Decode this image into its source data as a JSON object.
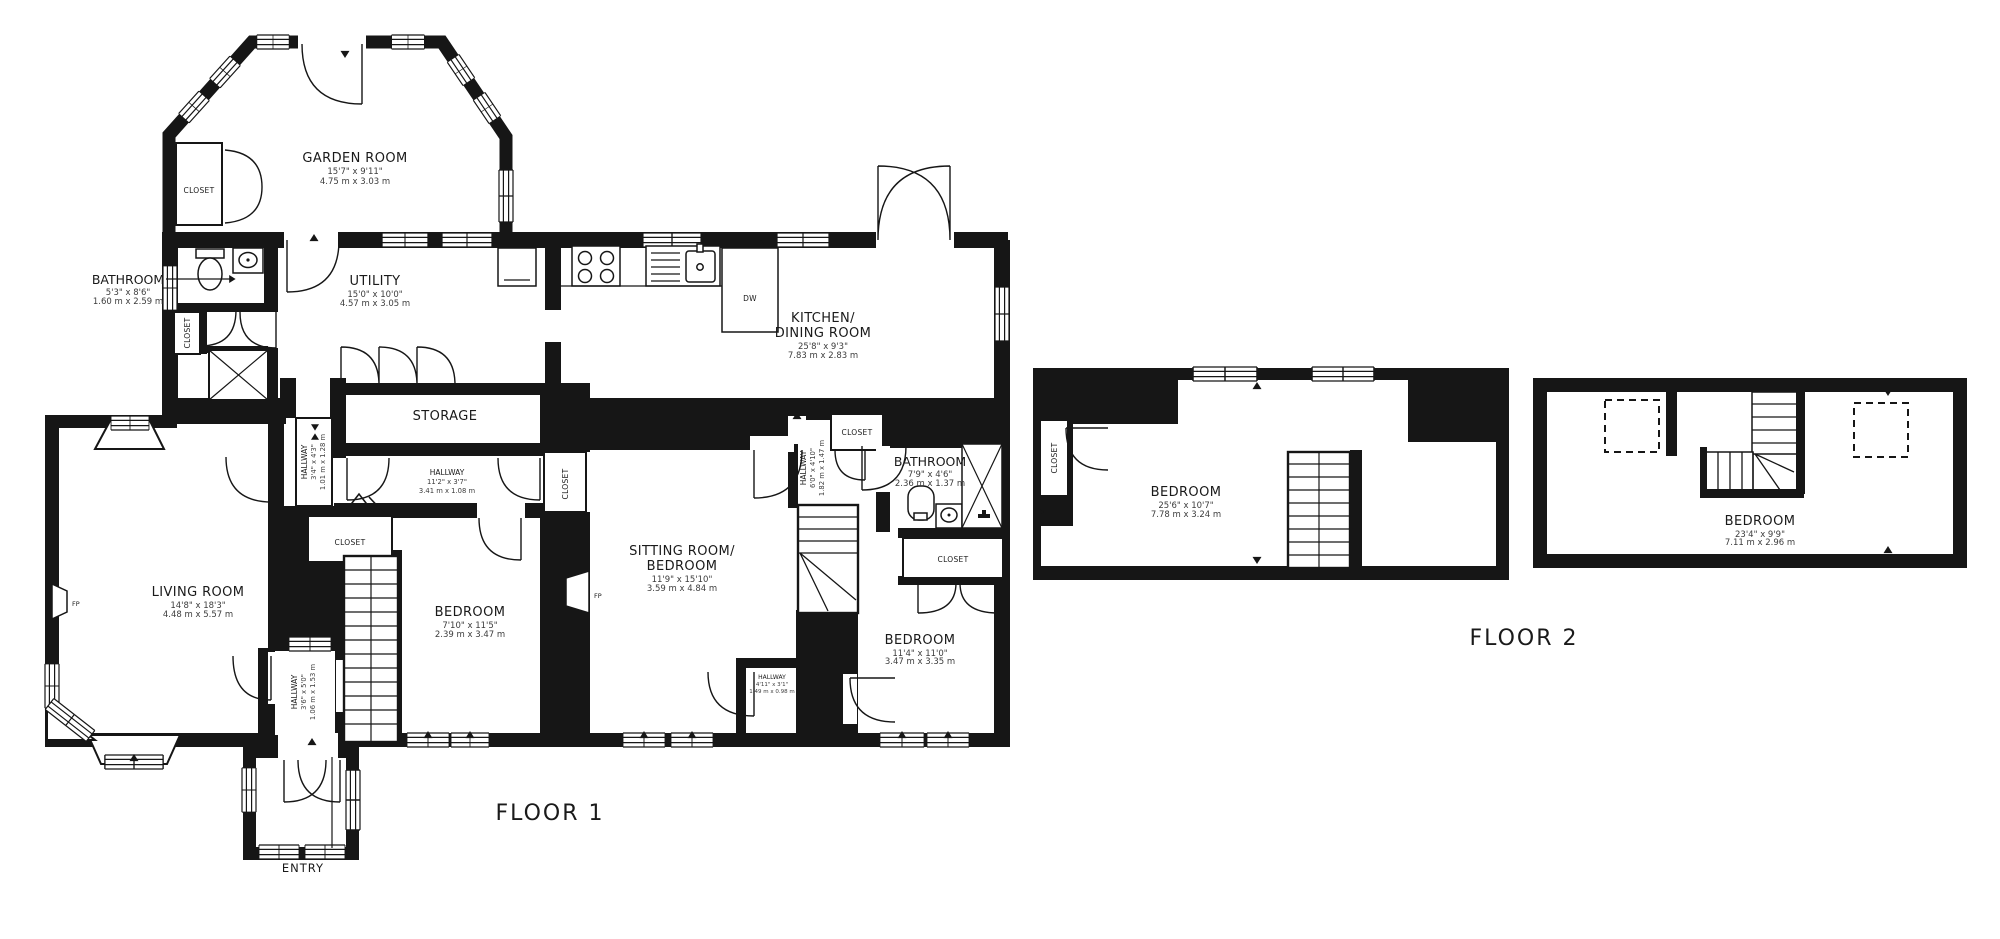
{
  "titles": {
    "floor1": "FLOOR 1",
    "floor2": "FLOOR 2",
    "entry": "ENTRY"
  },
  "shared": {
    "closet": "CLOSET",
    "dw": "DW",
    "fp": "FP"
  },
  "floor1": {
    "garden_room": {
      "name": "GARDEN ROOM",
      "size_ft": "15'7\" x 9'11\"",
      "size_m": "4.75 m x 3.03 m"
    },
    "bathroom1": {
      "name": "BATHROOM",
      "size_ft": "5'3\" x 8'6\"",
      "size_m": "1.60 m x 2.59 m"
    },
    "utility": {
      "name": "UTILITY",
      "size_ft": "15'0\" x 10'0\"",
      "size_m": "4.57 m x 3.05 m"
    },
    "kitchen": {
      "name_line1": "KITCHEN/",
      "name_line2": "DINING ROOM",
      "size_ft": "25'8\" x 9'3\"",
      "size_m": "7.83 m x 2.83 m"
    },
    "storage": {
      "name": "STORAGE"
    },
    "hallway_main": {
      "name": "HALLWAY",
      "size_ft": "11'2\" x 3'7\"",
      "size_m": "3.41 m x 1.08 m"
    },
    "hallway_side": {
      "name": "HALLWAY",
      "size_ft": "3'4\" x 4'3\"",
      "size_m": "1.01 m x 1.28 m"
    },
    "hallway_mid": {
      "name": "HALLWAY",
      "size_ft": "6'0\" x 4'10\"",
      "size_m": "1.82 m x 1.47 m"
    },
    "hallway_rear": {
      "name": "HALLWAY",
      "size_ft": "4'11\" x 3'1\"",
      "size_m": "1.49 m x 0.98 m"
    },
    "hallway_entry": {
      "name": "HALLWAY",
      "size_ft": "3'6\" x 5'0\"",
      "size_m": "1.06 m x 1.53 m"
    },
    "bathroom2": {
      "name": "BATHROOM",
      "size_ft": "7'9\" x 4'6\"",
      "size_m": "2.36 m x 1.37 m"
    },
    "living_room": {
      "name": "LIVING ROOM",
      "size_ft": "14'8\" x 18'3\"",
      "size_m": "4.48 m x 5.57 m"
    },
    "bedroom1": {
      "name": "BEDROOM",
      "size_ft": "7'10\" x 11'5\"",
      "size_m": "2.39 m x 3.47 m"
    },
    "sitting_room": {
      "name_line1": "SITTING ROOM/",
      "name_line2": "BEDROOM",
      "size_ft": "11'9\" x 15'10\"",
      "size_m": "3.59 m x 4.84 m"
    },
    "bedroom2": {
      "name": "BEDROOM",
      "size_ft": "11'4\" x 11'0\"",
      "size_m": "3.47 m x 3.35 m"
    }
  },
  "floor2": {
    "bedroom_left": {
      "name": "BEDROOM",
      "size_ft": "25'6\" x 10'7\"",
      "size_m": "7.78 m x 3.24 m"
    },
    "bedroom_right": {
      "name": "BEDROOM",
      "size_ft": "23'4\" x 9'9\"",
      "size_m": "7.11 m x 2.96 m"
    }
  }
}
